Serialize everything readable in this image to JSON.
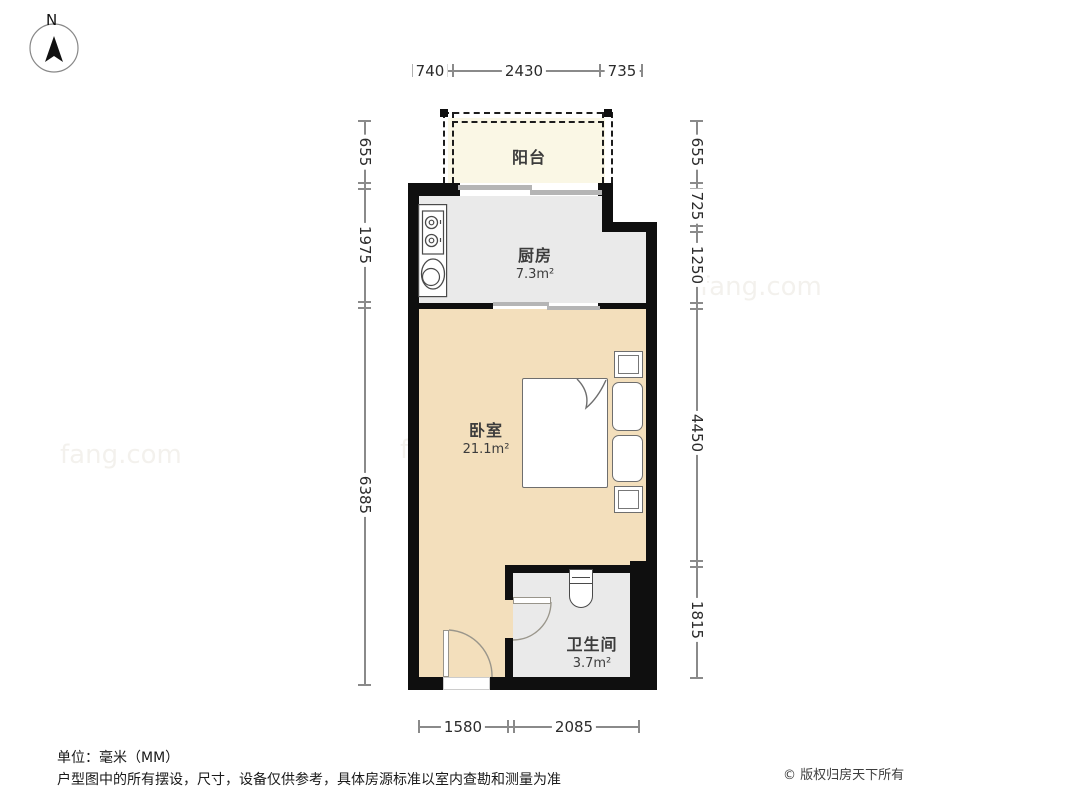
{
  "compass": {
    "label": "N"
  },
  "rooms": {
    "balcony": {
      "name": "阳台"
    },
    "kitchen": {
      "name": "厨房",
      "area": "7.3m²"
    },
    "bedroom": {
      "name": "卧室",
      "area": "21.1m²"
    },
    "bathroom": {
      "name": "卫生间",
      "area": "3.7m²"
    }
  },
  "dimensions": {
    "top": [
      "740",
      "2430",
      "735"
    ],
    "left": [
      "655",
      "1975",
      "6385"
    ],
    "right": [
      "655",
      "725",
      "1250",
      "4450",
      "1815"
    ],
    "bottom": [
      "1580",
      "2085"
    ]
  },
  "footer": {
    "unit": "单位：毫米（MM）",
    "disclaimer": "户型图中的所有摆设，尺寸，设备仅供参考，具体房源标准以室内查勘和测量为准",
    "copyright": "© 版权归房天下所有"
  },
  "watermark": {
    "text": "fang.com"
  },
  "colors": {
    "wall": "#0f0f0f",
    "bedroom_floor": "#f3dfbc",
    "kitchen_floor": "#eaeaea",
    "bathroom_floor": "#eaeaea",
    "balcony_floor": "#faf7e5",
    "dimension_line": "#8a8a8a",
    "sliding_door": "#b5b5b5"
  }
}
